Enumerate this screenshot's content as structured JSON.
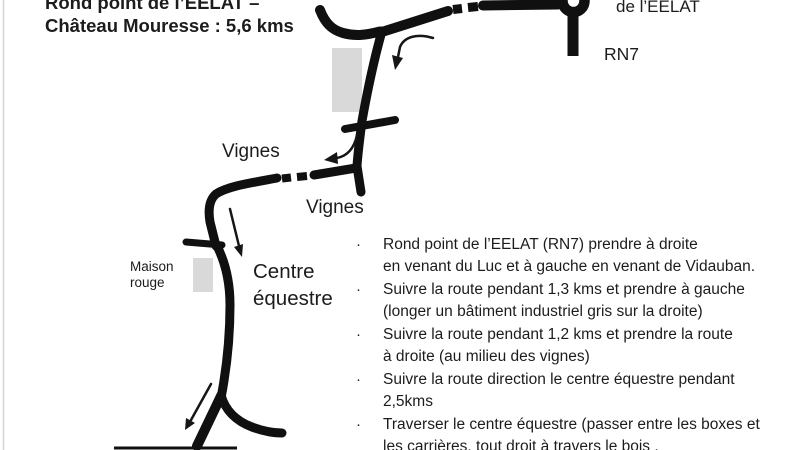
{
  "title": {
    "line1": "Rond point de l’EELAT –",
    "line2": "Château Mouresse : 5,6 kms"
  },
  "map": {
    "roundabout_label": "de l’EELAT",
    "rn7_label": "RN7",
    "vignes_label_upper": "Vignes",
    "vignes_label_lower": "Vignes",
    "maison_rouge_line1": "Maison",
    "maison_rouge_line2": "rouge",
    "centre_equestre_line1": "Centre",
    "centre_equestre_line2": "équestre",
    "colors": {
      "road": "#101010",
      "building_gray": "#d9d9d9",
      "text": "#1c1c1c"
    }
  },
  "directions": {
    "bullet": "·",
    "items": [
      {
        "lines": [
          "Rond point de l’EELAT  (RN7) prendre à droite",
          "en venant du Luc et à gauche en venant de Vidauban."
        ]
      },
      {
        "lines": [
          "Suivre la route pendant 1,3 kms et prendre à gauche",
          "(longer un bâtiment industriel gris sur la droite)"
        ]
      },
      {
        "lines": [
          "Suivre la route pendant 1,2 kms et prendre  la route",
          "à droite (au milieu des vignes)"
        ]
      },
      {
        "lines": [
          "Suivre la route direction le centre équestre pendant",
          "2,5kms"
        ]
      },
      {
        "lines": [
          "Traverser le centre équestre (passer entre les boxes et",
          "les carrières, tout droit à travers le bois ."
        ]
      }
    ]
  }
}
